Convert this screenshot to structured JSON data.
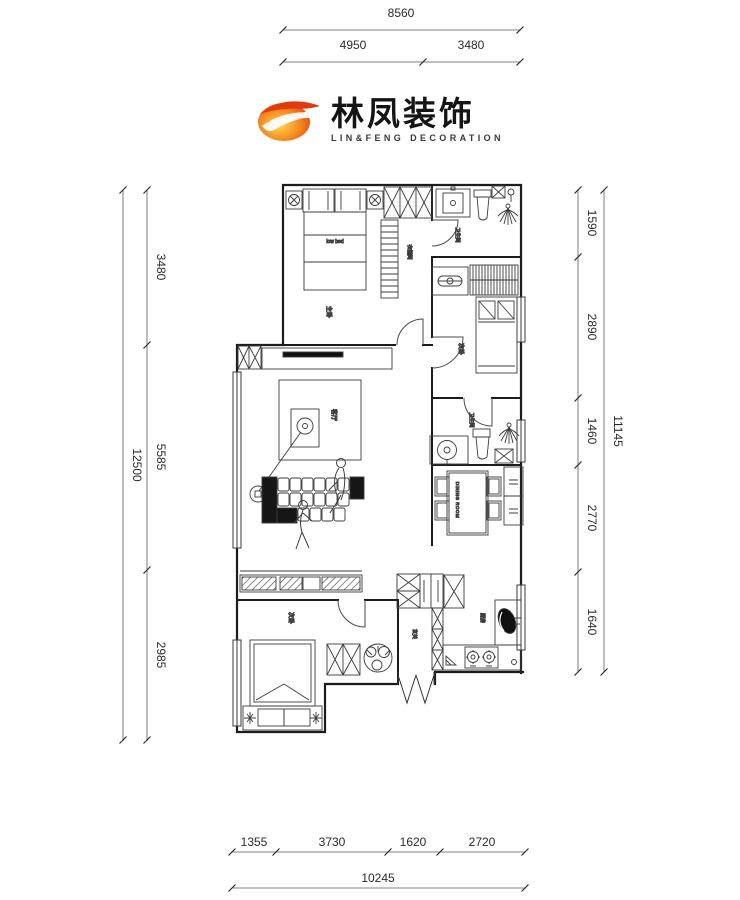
{
  "logo": {
    "brand_cn": "林凤装饰",
    "brand_en": "LIN&FENG DECORATION",
    "mark_color_outer": "#e23a0e",
    "mark_color_inner": "#ffd84d"
  },
  "dimensions": {
    "top_total": "8560",
    "top_segments": [
      "4950",
      "3480"
    ],
    "left_total": "12500",
    "left_segments": [
      "3480",
      "5585",
      "2985"
    ],
    "right_total": "11145",
    "right_segments": [
      "1590",
      "2890",
      "1460",
      "2770",
      "1640"
    ],
    "bottom_total": "10245",
    "bottom_segments": [
      "1355",
      "3730",
      "1620",
      "2720"
    ]
  },
  "rooms": {
    "master_bedroom": "主卧",
    "closet": "衣帽间",
    "bathroom_top": "卫生间",
    "bedroom_right": "次卧",
    "living_room": "客厅",
    "bathroom_mid": "卫生间",
    "dining_room": "DINING ROOM",
    "kitchen": "厨房",
    "entry": "玄关",
    "bedroom_bottom": "次卧",
    "bed_note": "low bed"
  }
}
